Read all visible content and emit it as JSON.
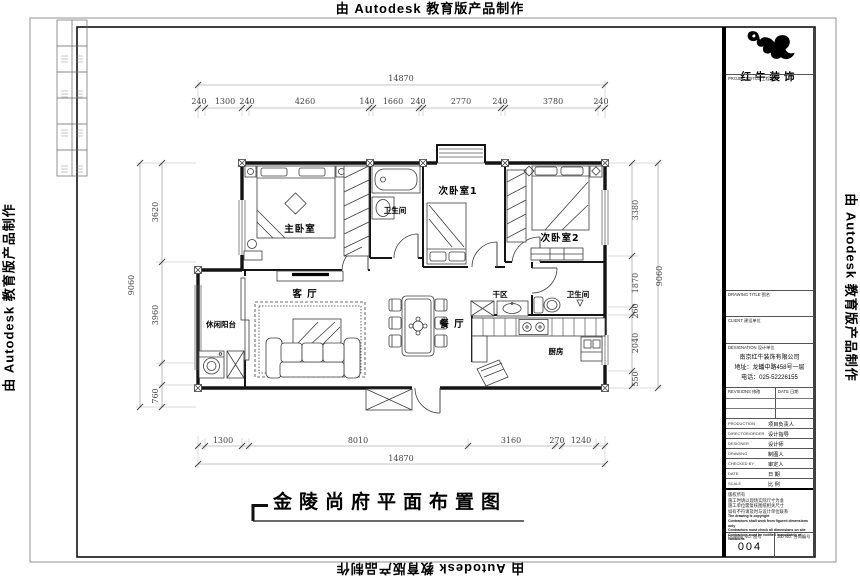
{
  "edge_text": "由 Autodesk 教育版产品制作",
  "sheet": {
    "title": "金陵尚府平面布置图"
  },
  "logo": {
    "name": "红牛装饰"
  },
  "title_block": {
    "project_title_label": "PROJECT/TITLE 工程名称",
    "drawing_title_label": "DRAWING TITLE 图名",
    "client_label": "CLIENT 建设单位",
    "designation_label": "DESIGNATION 设计单位",
    "company": "南京红牛装饰有限公司",
    "address": "地址：龙蟠中路458号一层",
    "phone": "电话：025-52226155",
    "revisions_label": "REVISIONS 修改",
    "date_col_label": "DATE 日期",
    "rows": [
      {
        "en": "PRODUCTION",
        "cn": "项目负责人"
      },
      {
        "en": "DIRECTOR/ORDER",
        "cn": "设计指导"
      },
      {
        "en": "DESIGNER",
        "cn": "设计师"
      },
      {
        "en": "DRAWING",
        "cn": "制图人"
      },
      {
        "en": "CHECKED BY",
        "cn": "审定人"
      },
      {
        "en": "DATE",
        "cn": "日 期"
      },
      {
        "en": "SCALE",
        "cn": "比 例"
      }
    ],
    "notes": [
      "版权所有",
      "施工时请以现场实际尺寸为准",
      "施工单位需复核图纸相关尺寸",
      "如有不符请及时与设计单位联系",
      "The drawing is copyright",
      "Contractors shall work from figured dimensions only",
      "Contractors must check all dimensions on site",
      "Contractors must be notified immediately of variations"
    ],
    "drawing_no_label": "Drawing NO. 图号",
    "drawing_no": "004",
    "job_no_label": "Job NO. 合同编号"
  },
  "plan": {
    "rooms": [
      "主卧室",
      "卫生间",
      "次卧室1",
      "次卧室2",
      "休闲阳台",
      "客 厅",
      "餐 厅",
      "干区",
      "卫生间",
      "厨房"
    ],
    "dims": {
      "top_total": "14870",
      "bottom_total": "14870",
      "left_total": "9060",
      "right_total": "9060",
      "top": [
        "240",
        "1300",
        "240",
        "4260",
        "140",
        "1660",
        "240",
        "2770",
        "240",
        "3780",
        "240"
      ],
      "bottom": [
        "1300",
        "8010",
        "3160",
        "270",
        "1240"
      ],
      "left": [
        "3620",
        "3960",
        "760"
      ],
      "right": [
        "3380",
        "1870",
        "260",
        "2040",
        "550"
      ]
    }
  }
}
